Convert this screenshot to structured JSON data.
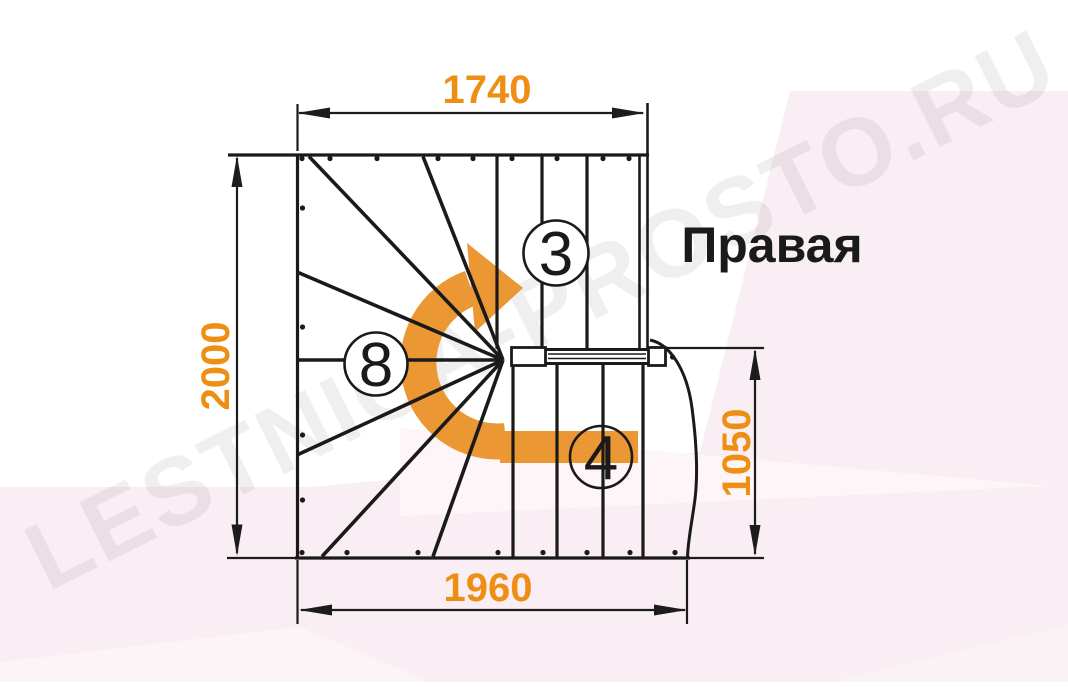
{
  "diagram": {
    "title_label": "Правая",
    "watermark": "LESTNICA-PROSTO.RU",
    "dimensions": {
      "top_width_mm": "1740",
      "left_height_mm": "2000",
      "right_lower_height_mm": "1050",
      "bottom_width_mm": "1960"
    },
    "step_counts": {
      "upper_flight": "3",
      "winder": "8",
      "lower_flight": "4"
    },
    "colors": {
      "dimension_text": "#EE8E13",
      "arrow": "#EB9734",
      "line": "#1A1A1A",
      "background_tint": "#F8EEF3"
    }
  }
}
